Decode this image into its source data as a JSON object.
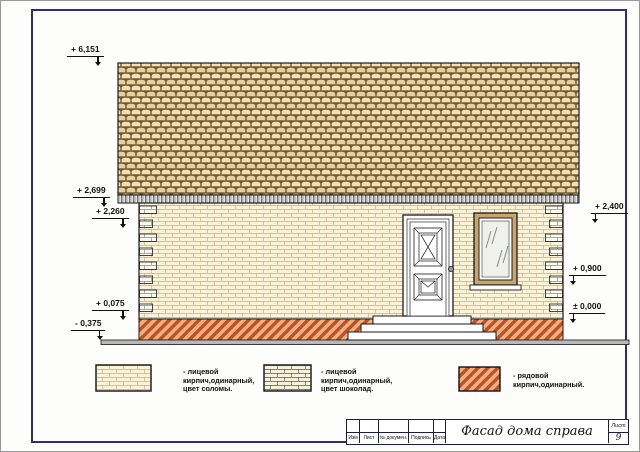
{
  "marks": {
    "ridge": "+ 6,151",
    "eaves": "+ 2,699",
    "wall_top_left": "+ 2,260",
    "porch": "+ 0,075",
    "ground": "- 0,375",
    "wall_top_right": "+ 2,400",
    "window_sill": "+ 0,900",
    "zero_level": "± 0,000"
  },
  "legend": {
    "items": [
      {
        "swatch": "straw-facing-brick",
        "lines": [
          "- лицевой",
          "кирпич,одинарный,",
          "цвет соломы."
        ]
      },
      {
        "swatch": "chocolate-facing-brick",
        "lines": [
          "- лицевой",
          "кирпич,одинарный,",
          "цвет шоколад."
        ]
      },
      {
        "swatch": "common-brick",
        "lines": [
          "- рядовой",
          "кирпич,одинарный."
        ]
      }
    ]
  },
  "title_block": {
    "columns": [
      "Изм",
      "Лист",
      "№ докумен.",
      "Подпись",
      "Дата"
    ],
    "title": "Фасад дома справа",
    "sheet_label": "Лист",
    "sheet_number": "9"
  },
  "colors": {
    "frame": "#2e2e6e",
    "roof_tile_face": "#efe0b8",
    "roof_tile_shadow": "#6e5128",
    "wall_brick": "#faf3d8",
    "wall_mortar": "#c6b183",
    "plinth_brick": "#bf4f24",
    "window_surround": "#c9a46b",
    "ground": "#b9b9b9"
  }
}
